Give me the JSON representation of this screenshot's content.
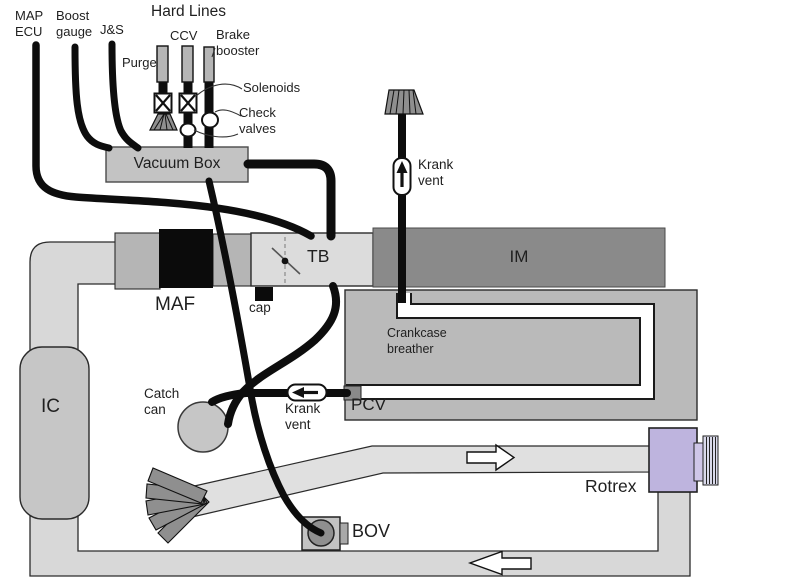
{
  "labels": {
    "map_ecu": "MAP\nECU",
    "boost_gauge": "Boost\ngauge",
    "js": "J&S",
    "hard_lines": "Hard Lines",
    "purge": "Purge",
    "ccv": "CCV",
    "brake_booster": "Brake\nbooster",
    "solenoids": "Solenoids",
    "check_valves": "Check\nvalves",
    "vacuum_box": "Vacuum Box",
    "krank_vent_top": "Krank\nvent",
    "maf": "MAF",
    "cap": "cap",
    "tb": "TB",
    "im": "IM",
    "crankcase_breather": "Crankcase\nbreather",
    "pcv": "PCV",
    "krank_vent_mid": "Krank\nvent",
    "catch_can": "Catch\ncan",
    "ic": "IC",
    "bov": "BOV",
    "rotrex": "Rotrex"
  },
  "colors": {
    "background": "#ffffff",
    "hose_black": "#0d0d0d",
    "pipe_light": "#d8d8d8",
    "pipe_diagonal": "#e0e0e0",
    "pipe_mid": "#b5b5b5",
    "engine_block": "#bababa",
    "im_gray": "#8a8a8a",
    "tb_light": "#dcdcdc",
    "vacuum_box_gray": "#c3c3c3",
    "catch_can_gray": "#c6c6c6",
    "filter_gray": "#8f8f8f",
    "rotrex_purple": "#beb4de",
    "bov_circle": "#8f8f8f",
    "text": "#1f1f1f"
  }
}
